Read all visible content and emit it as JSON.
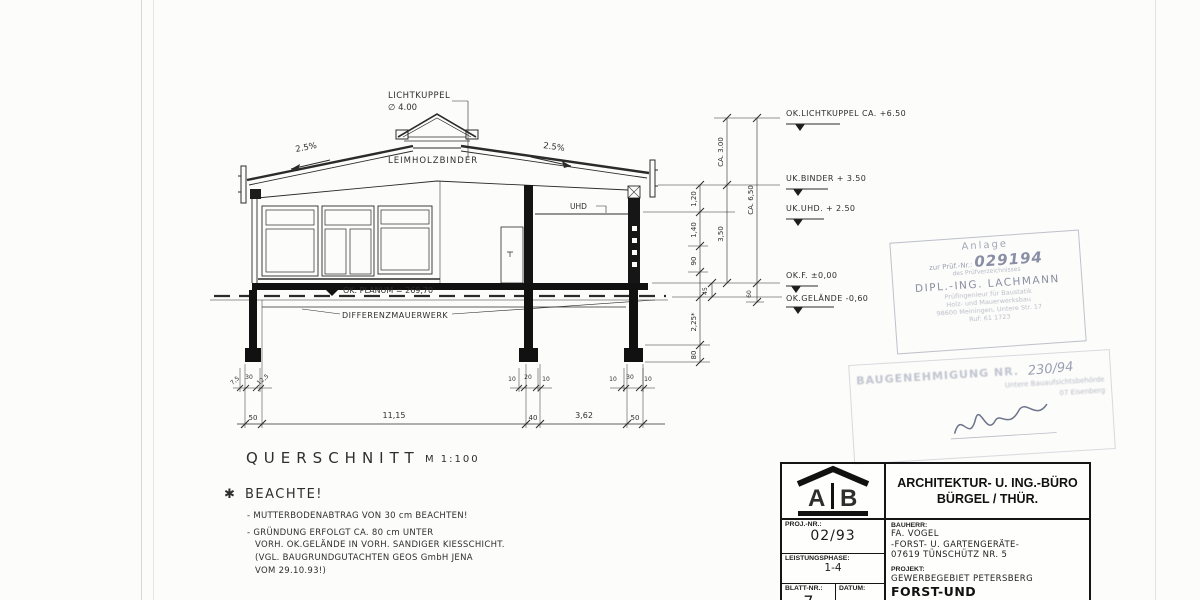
{
  "drawing": {
    "skylight_label": "LICHTKUPPEL",
    "skylight_dia": "∅ 4.00",
    "slope_left": "2.5%",
    "slope_right": "2.5%",
    "binder_label": "LEIMHOLZBINDER",
    "uhd_label": "UHD",
    "planum_label": "OK. PLANUM = 269,70",
    "diff_label": "DIFFERENZMAUERWERK",
    "section_title": "QUERSCHNITT",
    "section_scale": "M 1:100",
    "levels": {
      "lichtkuppel": "OK.LICHTKUPPEL CA. +6.50",
      "binder": "UK.BINDER + 3.50",
      "uhd": "UK.UHD. + 2.50",
      "floor": "OK.F. ±0,00",
      "gelaende": "OK.GELÄNDE -0,60"
    },
    "vdims": {
      "ca300": "CA. 3.00",
      "ca650": "CA. 6,50",
      "d350": "3,50",
      "d120": "1,20",
      "d140": "1,40",
      "d90": "90",
      "d45": "45",
      "d60": "60",
      "d225": "2,25*",
      "d80": "80"
    },
    "hdims": {
      "left50": "50",
      "span": "11,15",
      "mid40": "40",
      "gap": "3,62",
      "right50": "50"
    },
    "footdims": {
      "l1": "7,5",
      "l2": "30",
      "l3": "12,5",
      "m1": "10",
      "m2": "20",
      "m3": "10",
      "r1": "10",
      "r2": "30",
      "r3": "10"
    }
  },
  "notes": {
    "marker": "✱",
    "heading": "BEACHTE!",
    "line1": "- MUTTERBODENABTRAG VON 30 cm BEACHTEN!",
    "line2": "- GRÜNDUNG ERFOLGT CA. 80 cm UNTER",
    "line3": "VORH. OK.GELÄNDE IN VORH. SANDIGER KIESSCHICHT.",
    "line4": "(VGL. BAUGRUNDGUTACHTEN GEOS GmbH JENA",
    "line5": "VOM 29.10.93!)"
  },
  "stamp_pruef": {
    "line1": "Anlage",
    "line2_pre": "zur Prüf.-Nr.:",
    "number": "029194",
    "line3": "des Prüfverzeichnisses",
    "name": "DIPL.-ING. LACHMANN",
    "line5": "Prüfingenieur für Baustatik",
    "line6": "Holz- und Mauerwerksbau",
    "line7": "98600 Meiningen, Untere Str. 17",
    "line8": "Ruf: 61 1723"
  },
  "stamp_bau": {
    "title": "BAUGENEHMIGUNG NR.",
    "number": "230/94",
    "sub1": "Untere Bauaufsichtsbehörde",
    "sub2": "07 Eisenberg"
  },
  "titleblock": {
    "logo_a": "A",
    "logo_b": "B",
    "office1": "ARCHITEKTUR- U. ING.-BÜRO",
    "office2": "BÜRGEL / THÜR.",
    "proj_label": "PROJ.-NR.:",
    "proj_value": "02/93",
    "phase_label": "LEISTUNGSPHASE:",
    "phase_value": "1-4",
    "sheet_label": "BLATT-NR.:",
    "sheet_value": "7",
    "date_label": "DATUM:",
    "bauherr_label": "BAUHERR:",
    "bauherr1": "FA. VOGEL",
    "bauherr2": "-FORST- U. GARTENGERÄTE-",
    "bauherr3": "07619 TÜNSCHÜTZ NR. 5",
    "projekt_label": "PROJEKT:",
    "projekt1": "GEWERBEGEBIET PETERSBERG",
    "projekt2": "FORST-UND GARTENCENTER"
  }
}
